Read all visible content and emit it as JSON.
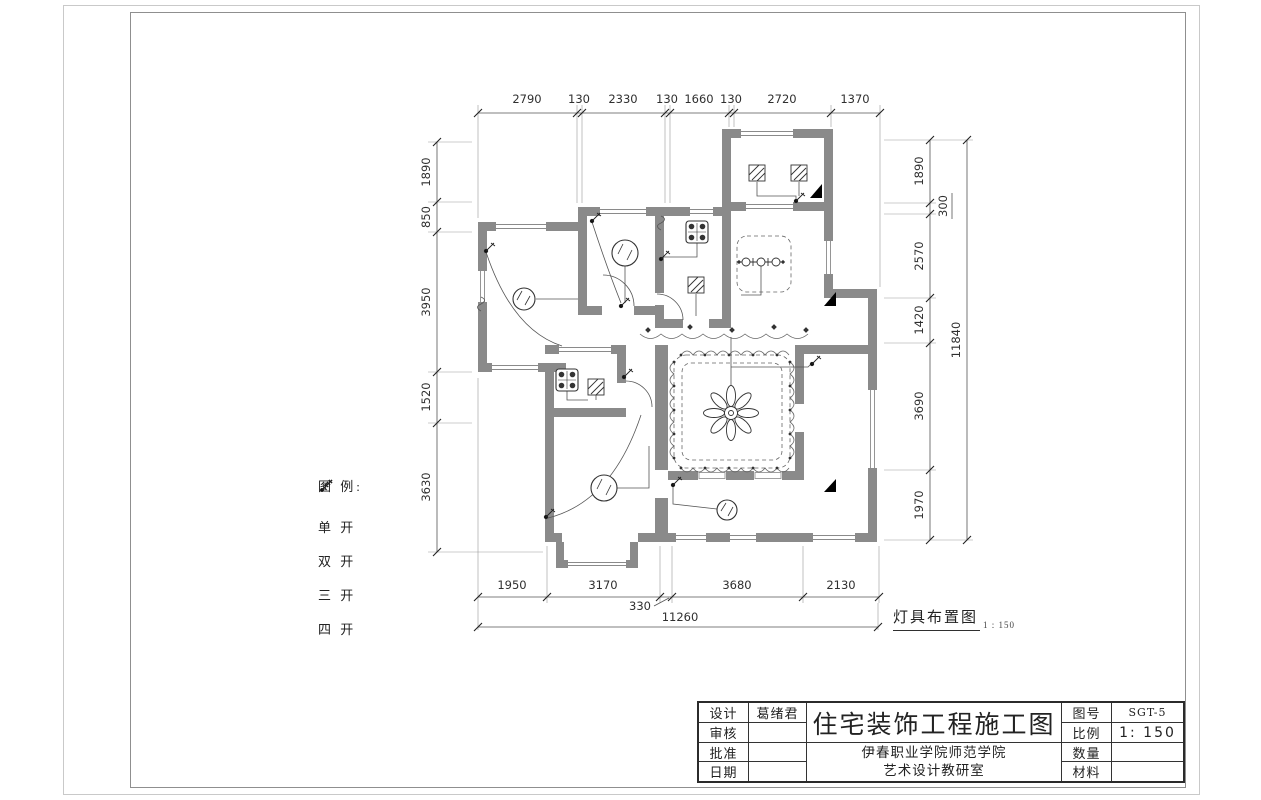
{
  "sheet": {
    "drawing_label": "灯具布置图",
    "drawing_scale": "1 : 150"
  },
  "legend": {
    "title": "图  例:",
    "items": [
      {
        "label": "单 开",
        "icon": "switch-1-gang-icon"
      },
      {
        "label": "双 开",
        "icon": "switch-2-gang-icon"
      },
      {
        "label": "三 开",
        "icon": "switch-3-gang-icon"
      },
      {
        "label": "四 开",
        "icon": "switch-4-gang-icon"
      }
    ]
  },
  "dimensions": {
    "top": [
      "2790",
      "130",
      "2330",
      "130",
      "1660",
      "130",
      "2720",
      "1370"
    ],
    "left": [
      "1890",
      "850",
      "3950",
      "1520",
      "3630"
    ],
    "right": [
      "1890",
      "300",
      "2570",
      "1420",
      "3690",
      "1970"
    ],
    "right_total": "11840",
    "bottom": [
      "1950",
      "3170",
      "3680",
      "2130"
    ],
    "bottom_inset": "330",
    "bottom_total": "11260"
  },
  "title_block": {
    "main_title": "住宅装饰工程施工图",
    "org_line1": "伊春职业学院师范学院",
    "org_line2": "艺术设计教研室",
    "left_rows": [
      {
        "label": "设计",
        "value": "葛绪君"
      },
      {
        "label": "审核",
        "value": ""
      },
      {
        "label": "批准",
        "value": ""
      },
      {
        "label": "日期",
        "value": ""
      }
    ],
    "right_rows": [
      {
        "label": "图号",
        "value": "SGT-5"
      },
      {
        "label": "比例",
        "value": "1: 150"
      },
      {
        "label": "数量",
        "value": ""
      },
      {
        "label": "材料",
        "value": ""
      }
    ]
  },
  "symbols": {
    "wall_color": "#8a8a8a",
    "line_color": "#4a4a4a",
    "fixtures": [
      "ceiling-lamp",
      "downlight-hatched",
      "grille-light",
      "chandelier",
      "wall-switch",
      "black-section-flag"
    ]
  }
}
